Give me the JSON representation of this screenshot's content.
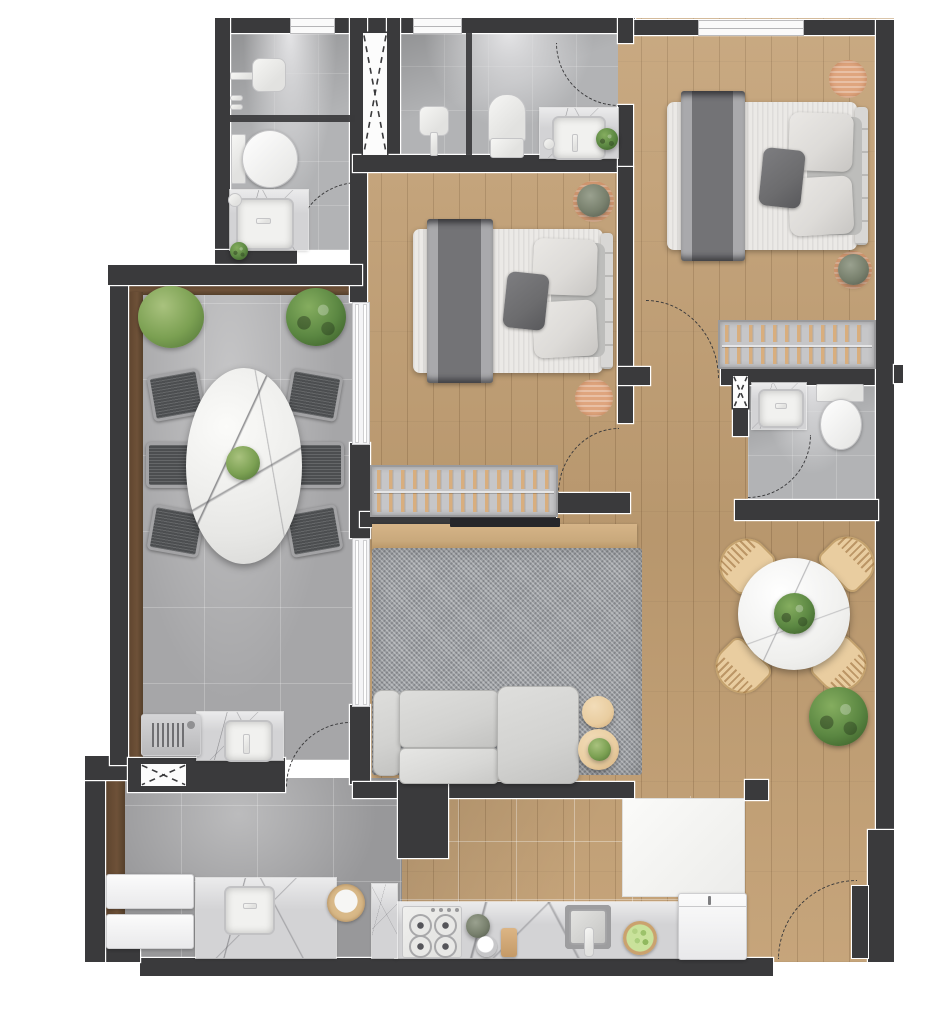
{
  "palette": {
    "wall": "#3a3a3c",
    "keyline": "#ffffff",
    "wood": "#c3a074",
    "wood_line": "rgba(92,62,30,0.22)",
    "trim_brown": "#6e5138",
    "terrace_tile": "#a6a6a8",
    "service_tile": "#98989a",
    "kitchen_floor": "#c6c6c8",
    "bath_tile": "#b2b3b5",
    "shaft_white": "#fcfcfc",
    "rug": "#9c9fa3",
    "rug_tan": "#dfa57e",
    "sofa": "#d2d2d0",
    "sofa_line": "#b5b5b3",
    "mattress": "#ebe9e6",
    "blanket": "#737376",
    "blanket_edge": "#a9a9ac",
    "pillow": "#dddbd8",
    "pillow_dark": "#6c6c6e",
    "headboard": "#d8d7d5",
    "marble_white": "#f2f2f0",
    "counter_marble": "#d3d3d5",
    "basin": "#f1f1ef",
    "closet_bg": "#c6c6c8",
    "closet_border": "#9a9a9c",
    "hanger": "#d8ae7e",
    "chair_dark": "#4c4e50",
    "chair_frame": "#a3a3a5",
    "chair_tan": "#e9cda0",
    "plant": "#5b8742",
    "plant_light": "#85ad5f",
    "plant_dark": "#3c5f2a",
    "fixture": "#e2e2e0",
    "tv": "#26262a",
    "arc": "#3a3a3c",
    "wood_console": "#c9a97c"
  },
  "rooms": [
    {
      "name": "bathroom-top-left",
      "furniture": [
        "shower",
        "glass-divider",
        "toilet",
        "vanity-sink",
        "door-arc",
        "window"
      ]
    },
    {
      "name": "ventilation-shaft",
      "furniture": [
        "x-hatch"
      ]
    },
    {
      "name": "bathroom-top-middle",
      "furniture": [
        "shower",
        "glass-divider",
        "toilet",
        "vanity-sink",
        "plant",
        "door-arc",
        "window"
      ]
    },
    {
      "name": "master-bedroom",
      "furniture": [
        "double-bed",
        "round-rug",
        "round-rug-plant",
        "wardrobe-hangers",
        "window",
        "door-arc"
      ]
    },
    {
      "name": "bedroom-2",
      "furniture": [
        "double-bed",
        "round-rug",
        "round-rug-plant",
        "wardrobe-hangers",
        "door-arc"
      ]
    },
    {
      "name": "bathroom-small",
      "furniture": [
        "vanity-sink",
        "toilet",
        "vent-window",
        "door-arc"
      ]
    },
    {
      "name": "terrace-dining",
      "furniture": [
        "oval-marble-table",
        "six-dark-chairs",
        "two-plants",
        "centerpiece-plant"
      ]
    },
    {
      "name": "living-room",
      "furniture": [
        "tv",
        "tv-console",
        "area-rug",
        "sofa",
        "two-side-tables",
        "plant"
      ]
    },
    {
      "name": "dining-right",
      "furniture": [
        "round-marble-table",
        "four-rattan-chairs",
        "centerpiece-plant",
        "floor-plant"
      ]
    },
    {
      "name": "kitchen",
      "furniture": [
        "counter",
        "stove",
        "sink",
        "faucet",
        "fruit-bowl",
        "cutting-board",
        "bowl",
        "flowers",
        "refrigerator",
        "window"
      ]
    },
    {
      "name": "service-area",
      "furniture": [
        "washer",
        "dryer",
        "counter",
        "utility-sink",
        "basket",
        "grill-counter",
        "grill",
        "grill-sink",
        "window",
        "door-arc"
      ]
    },
    {
      "name": "entry",
      "furniture": [
        "door-leaf",
        "door-arc"
      ]
    }
  ]
}
